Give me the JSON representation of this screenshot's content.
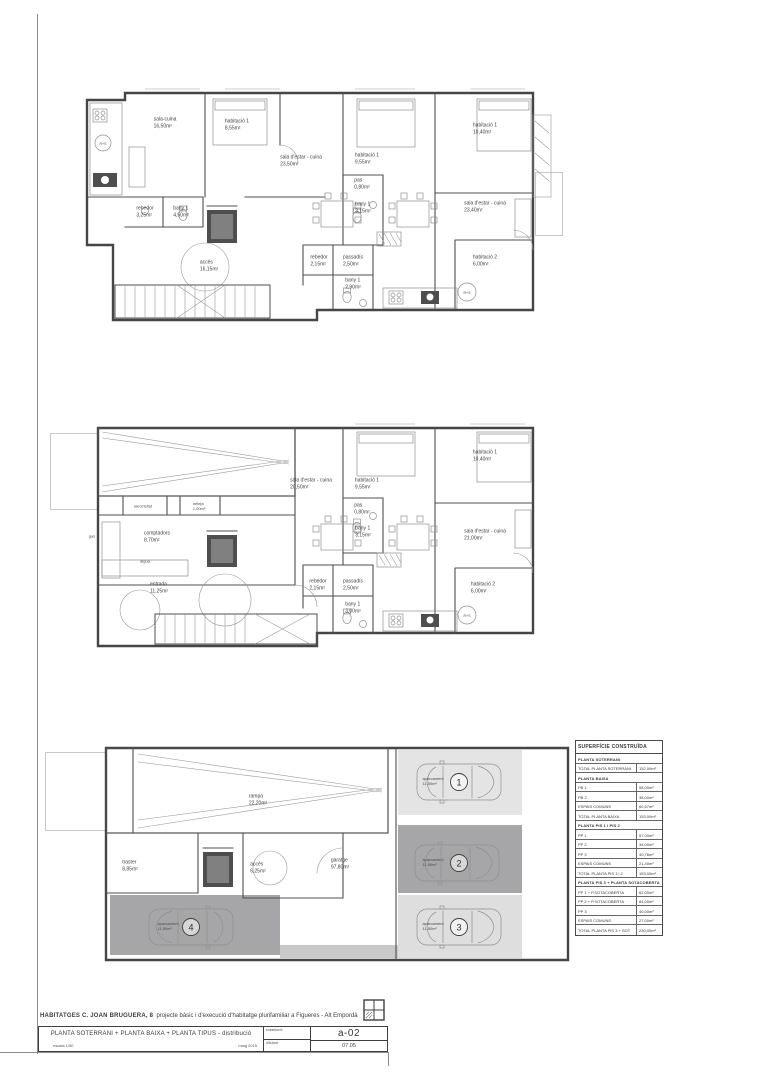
{
  "sheet": {
    "project_name": "HABITATGES C. JOAN BRUGUERA, 8",
    "project_desc": "projecte bàsic i d'execució d'habitatge plurifamiliar a Figueres - Alt Empordà",
    "drawing_title": "PLANTA SOTERRANI + PLANTA BAIXA + PLANTA TIPUS - distribució",
    "scale": "escala 1/50",
    "date": "maig 2015",
    "field_top": "substitueix",
    "field_bottom": "dibuixat",
    "sheet_code": "a-02",
    "sheet_num": "07.05"
  },
  "table": {
    "title": "SUPERFÍCIE CONSTRUÏDA",
    "rows": [
      {
        "type": "section",
        "label": "PLANTA SOTERRANI"
      },
      {
        "type": "data",
        "label": "TOTAL PLANTA SOTERRANI",
        "value": "152,00m²"
      },
      {
        "type": "section",
        "label": "PLANTA BAIXA"
      },
      {
        "type": "data",
        "label": "PB 1",
        "value": "58,00m²"
      },
      {
        "type": "data",
        "label": "PB 2",
        "value": "38,00m²"
      },
      {
        "type": "data",
        "label": "ESPAIS COMUNS",
        "value": "60,57m²"
      },
      {
        "type": "data",
        "label": "TOTAL PLANTA BAIXA",
        "value": "153,00m²"
      },
      {
        "type": "section",
        "label": "PLANTA PIS 1 i PIS 2"
      },
      {
        "type": "data",
        "label": "PP 1",
        "value": "57,00m²"
      },
      {
        "type": "data",
        "label": "PP 2",
        "value": "34,00m²"
      },
      {
        "type": "data",
        "label": "PP 3",
        "value": "40,76m²"
      },
      {
        "type": "data",
        "label": "ESPAIS COMUNS",
        "value": "21,40m²"
      },
      {
        "type": "data",
        "label": "TOTAL PLANTA PIS 1 i 2",
        "value": "153,00m²"
      },
      {
        "type": "section",
        "label": "PLANTA PIS 3 + PLANTA SOTACOBERTA"
      },
      {
        "type": "data",
        "label": "PP 1 + P.SOTACOBERTA",
        "value": "62,00m²"
      },
      {
        "type": "data",
        "label": "PP 2 + P.SOTACOBERTA",
        "value": "84,00m²"
      },
      {
        "type": "data",
        "label": "PP 3",
        "value": "40,00m²"
      },
      {
        "type": "data",
        "label": "ESPAIS COMUNS",
        "value": "27,00m²"
      },
      {
        "type": "data",
        "label": "TOTAL PLANTA PIS 3 + SOT",
        "value": "230,00m²"
      }
    ]
  },
  "plans": {
    "tipus": {
      "labels": [
        "sala-cuina\n16,50m²",
        "habitació 1\n8,55m²",
        "sala d'estar - cuina\n23,50m²",
        "rebedor\n3,25m²",
        "bany 1\n4,50m²",
        "accés\n16,15m²",
        "habitació 1\n9,55m²",
        "pas\n0,80m²",
        "bany 1\n3,15m²",
        "habitació 1\n10,40m²",
        "sala d'estar - cuina\n23,40m²",
        "rebedor\n2,15m²",
        "passadís\n2,50m²",
        "bany 1\n2,90m²",
        "habitació 2\n6,00m²"
      ]
    },
    "baixa": {
      "labels": [
        "electricitat",
        "neteja\n1,00m²",
        "comptadors\n8,70m²",
        "gas",
        "aigua",
        "entrada\n11,25m²",
        "sala d'estar - cuina\n20,50m²",
        "habitació 1\n9,55m²",
        "pas\n0,80m²",
        "bany 1\n3,15m²",
        "habitació 1\n10,40m²",
        "sala d'estar - cuina\n21,00m²",
        "rebedor\n2,15m²",
        "passadís\n2,50m²",
        "bany 1\n3,00m²",
        "habitació 2\n6,00m²"
      ]
    },
    "soterrani": {
      "labels": [
        "rampa\n22,20m²",
        "traster\n8,85m²",
        "accés\n6,25m²",
        "garatge\n97,80m²"
      ],
      "parking": [
        {
          "num": "1",
          "label": "aparcament\n11,50m²"
        },
        {
          "num": "2",
          "label": "aparcament\n11,50m²"
        },
        {
          "num": "3",
          "label": "aparcament\n11,50m²"
        },
        {
          "num": "4",
          "label": "aparcament\n11,50m²"
        }
      ],
      "fridge_label": "R+S"
    }
  }
}
